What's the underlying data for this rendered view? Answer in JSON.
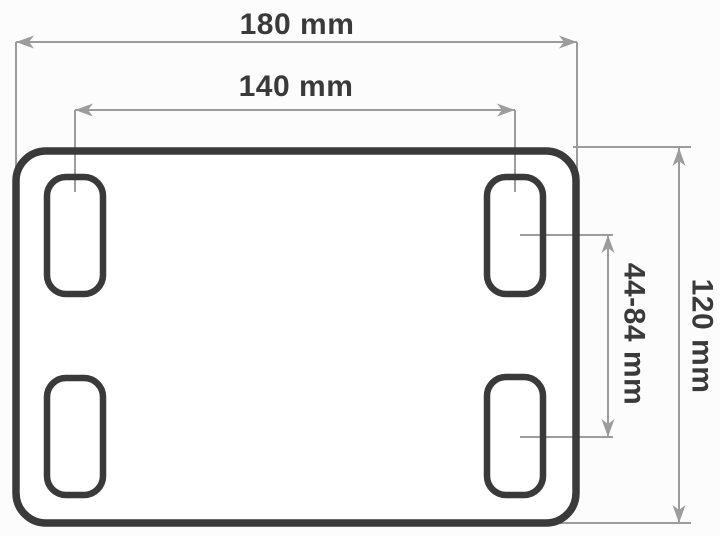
{
  "diagram": {
    "kind": "technical-dimension-drawing",
    "subject": "mounting plate with four slotted holes, top view",
    "labels": {
      "width_overall": "180 mm",
      "slot_spacing_horizontal": "140 mm",
      "height_overall": "120 mm",
      "slot_spacing_vertical": "44-84 mm"
    },
    "slot_count": 4,
    "colors": {
      "plate_outline": "#3a3a3a",
      "dimension_lines": "#9c9c9c",
      "label_text": "#3a3a3a",
      "background": "#fcfcfc",
      "plate_fill": "#ffffff"
    }
  }
}
